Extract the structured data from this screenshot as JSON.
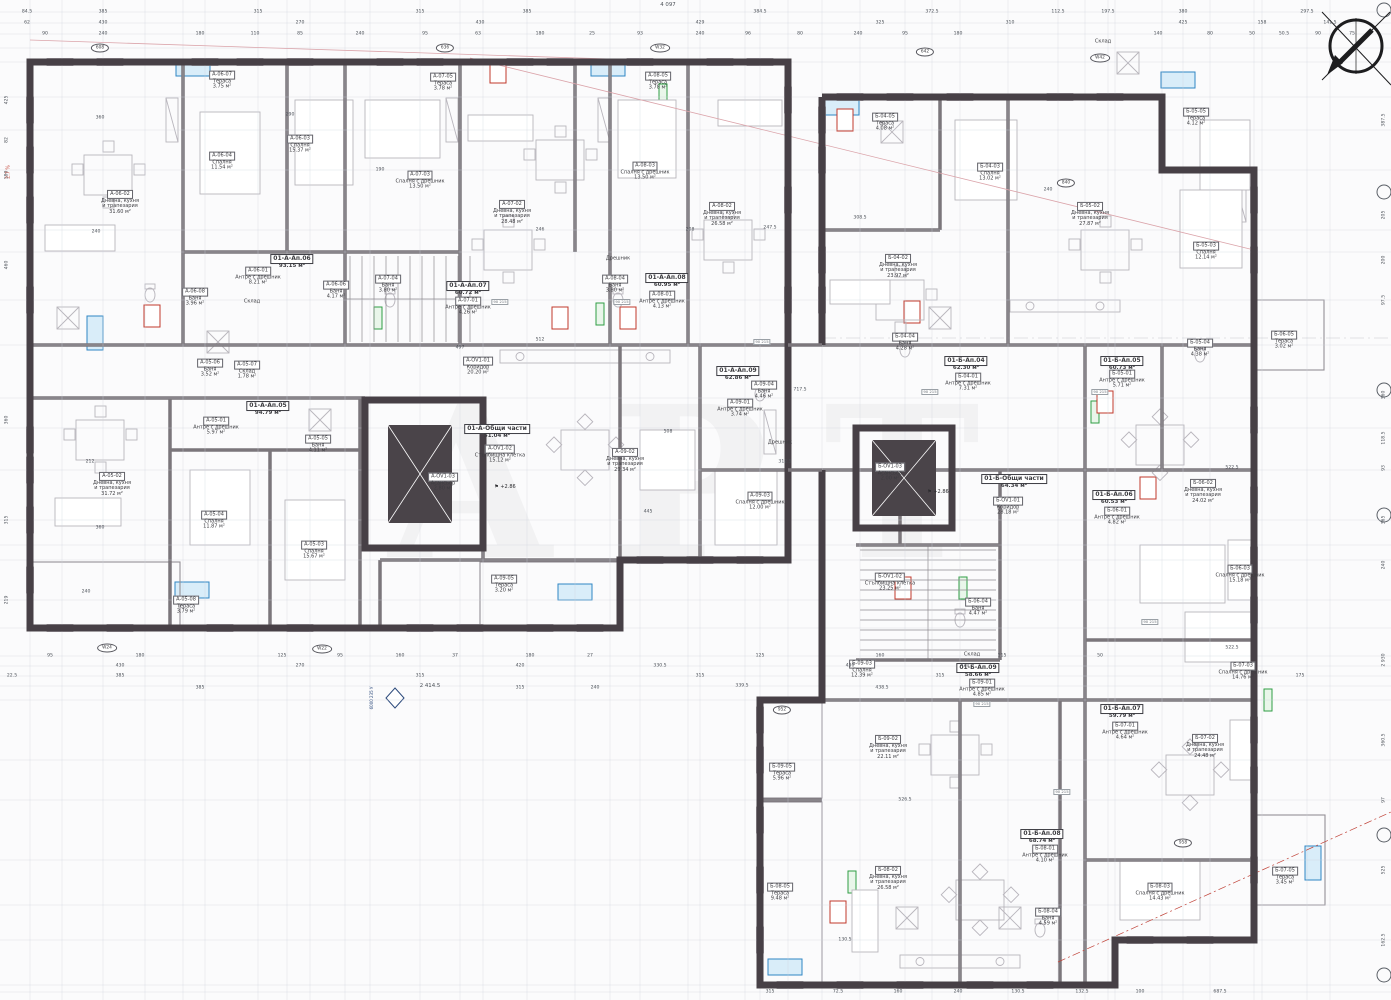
{
  "drawing": {
    "watermark": "АРТ",
    "overall_top": "4 097",
    "overall_bottom": "2 414.5",
    "door_tag": {
      "top": "90",
      "bottom": "215"
    },
    "section_marker": {
      "line1": "6000",
      "line2": "235 У"
    },
    "left_note": "2.7 %"
  },
  "rooms": [
    {
      "code": "А-06-02",
      "name": "Дневна, кухня\nи трапезария",
      "area": "31.60 м²",
      "x": 120,
      "y": 198
    },
    {
      "code": "А-06-04",
      "name": "Спалня",
      "area": "11.54 м²",
      "x": 222,
      "y": 157
    },
    {
      "code": "А-06-03",
      "name": "Спалня",
      "area": "15.37 м²",
      "x": 300,
      "y": 140
    },
    {
      "code": "А-06-07",
      "name": "Тераса",
      "area": "3.75 м²",
      "x": 222,
      "y": 76
    },
    {
      "code": "А-06-01",
      "name": "Антре с дрешник",
      "area": "8.21 м²",
      "x": 258,
      "y": 272
    },
    {
      "code": "А-06-06",
      "name": "Баня",
      "area": "4.17 м²",
      "x": 336,
      "y": 286
    },
    {
      "code": "А-06-08",
      "name": "Баня",
      "area": "3.96 м²",
      "x": 195,
      "y": 293
    },
    {
      "code": "А-07-03",
      "name": "Спалня с дрешник",
      "area": "13.50 м²",
      "x": 420,
      "y": 176
    },
    {
      "code": "А-07-02",
      "name": "Дневна, кухня\nи трапезария",
      "area": "28.48 м²",
      "x": 512,
      "y": 208
    },
    {
      "code": "А-07-05",
      "name": "Тераса",
      "area": "3.78 м²",
      "x": 443,
      "y": 78
    },
    {
      "code": "А-07-01",
      "name": "Антре с дрешник",
      "area": "4.26 м²",
      "x": 468,
      "y": 302
    },
    {
      "code": "А-07-04",
      "name": "Баня",
      "area": "3.80 м²",
      "x": 388,
      "y": 280
    },
    {
      "code": "А-08-03",
      "name": "Спалня с дрешник",
      "area": "13.50 м²",
      "x": 645,
      "y": 167
    },
    {
      "code": "А-08-02",
      "name": "Дневна, кухня\nи трапезария",
      "area": "26.58 м²",
      "x": 722,
      "y": 210
    },
    {
      "code": "А-08-05",
      "name": "Тераса",
      "area": "3.78 м²",
      "x": 658,
      "y": 77
    },
    {
      "code": "А-08-04",
      "name": "Баня",
      "area": "3.80 м²",
      "x": 615,
      "y": 280
    },
    {
      "code": "А-08-01",
      "name": "Антре с дрешник",
      "area": "4.13 м²",
      "x": 662,
      "y": 296
    },
    {
      "code": "А-05-06",
      "name": "Баня",
      "area": "3.52 м²",
      "x": 210,
      "y": 364
    },
    {
      "code": "А-05-07",
      "name": "Склад",
      "area": "1.78 м²",
      "x": 247,
      "y": 366
    },
    {
      "code": "А-05-01",
      "name": "Антре с дрешник",
      "area": "5.97 м²",
      "x": 216,
      "y": 422
    },
    {
      "code": "А-05-05",
      "name": "Баня",
      "area": "4.11 м²",
      "x": 318,
      "y": 440
    },
    {
      "code": "А-05-02",
      "name": "Дневна, кухня\nи трапезария",
      "area": "31.72 м²",
      "x": 112,
      "y": 480
    },
    {
      "code": "А-05-04",
      "name": "Спалня",
      "area": "11.87 м²",
      "x": 214,
      "y": 516
    },
    {
      "code": "А-05-03",
      "name": "Спалня",
      "area": "15.67 м²",
      "x": 314,
      "y": 546
    },
    {
      "code": "А-05-08",
      "name": "Тераса",
      "area": "3.79 м²",
      "x": 186,
      "y": 601
    },
    {
      "code": "А-OV1-01",
      "name": "Коридор",
      "area": "20.20 м²",
      "x": 478,
      "y": 362
    },
    {
      "code": "А-OV1-02",
      "name": "Стълбищна клетка",
      "area": "15.12 м²",
      "x": 500,
      "y": 450
    },
    {
      "code": "А-OV1-03",
      "name": "Асансьор",
      "area": "2.80 м²",
      "x": 443,
      "y": 478
    },
    {
      "code": "А-09-02",
      "name": "Дневна, кухня\nи трапезария",
      "area": "29.34 м²",
      "x": 625,
      "y": 456
    },
    {
      "code": "А-09-05",
      "name": "Тераса",
      "area": "3.20 м²",
      "x": 504,
      "y": 580
    },
    {
      "code": "А-09-03",
      "name": "Спалня с дрешник",
      "area": "12.00 м²",
      "x": 760,
      "y": 497
    },
    {
      "code": "А-09-04",
      "name": "Баня",
      "area": "4.46 м²",
      "x": 764,
      "y": 386
    },
    {
      "code": "А-09-01",
      "name": "Антре с дрешник",
      "area": "3.74 м²",
      "x": 740,
      "y": 404
    },
    {
      "code": "Б-04-05",
      "name": "Тераса",
      "area": "4.08 м²",
      "x": 885,
      "y": 118
    },
    {
      "code": "Б-04-03",
      "name": "Спалня",
      "area": "13.02 м²",
      "x": 990,
      "y": 168
    },
    {
      "code": "Б-04-02",
      "name": "Дневна, кухня\nи трапезария",
      "area": "23.97 м²",
      "x": 898,
      "y": 262
    },
    {
      "code": "Б-04-01",
      "name": "Антре с дрешник",
      "area": "7.31 м²",
      "x": 968,
      "y": 378
    },
    {
      "code": "Б-04-04",
      "name": "Баня",
      "area": "4.28 м²",
      "x": 905,
      "y": 338
    },
    {
      "code": "Б-05-02",
      "name": "Дневна, кухня\nи трапезария",
      "area": "27.87 м²",
      "x": 1090,
      "y": 210
    },
    {
      "code": "Б-05-05",
      "name": "Тераса",
      "area": "4.12 м²",
      "x": 1196,
      "y": 113
    },
    {
      "code": "Б-05-03",
      "name": "Спалня",
      "area": "12.14 м²",
      "x": 1206,
      "y": 247
    },
    {
      "code": "Б-05-04",
      "name": "Баня",
      "area": "4.38 м²",
      "x": 1200,
      "y": 344
    },
    {
      "code": "Б-05-01",
      "name": "Антре с дрешник",
      "area": "5.71 м²",
      "x": 1122,
      "y": 375
    },
    {
      "code": "Б-06-05",
      "name": "Тераса",
      "area": "3.02 м²",
      "x": 1284,
      "y": 336
    },
    {
      "code": "Б-06-02",
      "name": "Дневна, кухня\nи трапезария",
      "area": "24.02 м²",
      "x": 1203,
      "y": 487
    },
    {
      "code": "Б-06-03",
      "name": "Спалня с дрешник",
      "area": "15.18 м²",
      "x": 1240,
      "y": 570
    },
    {
      "code": "Б-06-01",
      "name": "Антре с дрешник",
      "area": "4.82 м²",
      "x": 1117,
      "y": 512
    },
    {
      "code": "Б-06-04",
      "name": "Баня",
      "area": "4.47 м²",
      "x": 978,
      "y": 603
    },
    {
      "code": "Б-OV1-01",
      "name": "Коридор",
      "area": "28.18 м²",
      "x": 1008,
      "y": 502
    },
    {
      "code": "Б-OV1-02",
      "name": "Стълбищна клетка",
      "area": "23.25 м²",
      "x": 890,
      "y": 578
    },
    {
      "code": "Б-OV1-03",
      "name": "Асансьор",
      "area": "2.00 м²",
      "x": 890,
      "y": 468
    },
    {
      "code": "Б-09-03",
      "name": "Спалня",
      "area": "12.39 м²",
      "x": 862,
      "y": 665
    },
    {
      "code": "Б-09-01",
      "name": "Антре с дрешник",
      "area": "4.85 м²",
      "x": 982,
      "y": 684
    },
    {
      "code": "Б-09-02",
      "name": "Дневна, кухня\nи трапезария",
      "area": "22.11 м²",
      "x": 888,
      "y": 743
    },
    {
      "code": "Б-09-05",
      "name": "Тераса",
      "area": "5.96 м²",
      "x": 782,
      "y": 768
    },
    {
      "code": "Б-08-05",
      "name": "Тераса",
      "area": "9.48 м²",
      "x": 780,
      "y": 888
    },
    {
      "code": "Б-08-02",
      "name": "Дневна, кухня\nи трапезария",
      "area": "26.58 м²",
      "x": 888,
      "y": 874
    },
    {
      "code": "Б-08-01",
      "name": "Антре с дрешник",
      "area": "4.10 м²",
      "x": 1045,
      "y": 850
    },
    {
      "code": "Б-08-04",
      "name": "Баня",
      "area": "4.59 м²",
      "x": 1048,
      "y": 913
    },
    {
      "code": "Б-08-03",
      "name": "Спалня с дрешник",
      "area": "14.43 м²",
      "x": 1160,
      "y": 888
    },
    {
      "code": "Б-07-03",
      "name": "Спалня с дрешник",
      "area": "14.76 м²",
      "x": 1243,
      "y": 667
    },
    {
      "code": "Б-07-01",
      "name": "Антре с дрешник",
      "area": "4.64 м²",
      "x": 1125,
      "y": 727
    },
    {
      "code": "Б-07-02",
      "name": "Дневна, кухня\nи трапезария",
      "area": "24.48 м²",
      "x": 1205,
      "y": 742
    },
    {
      "code": "Б-07-05",
      "name": "Тераса",
      "area": "3.45 м²",
      "x": 1285,
      "y": 872
    }
  ],
  "units": [
    {
      "code": "01-А-Ап.06",
      "area": "93.15 м²",
      "x": 292,
      "y": 258
    },
    {
      "code": "01-А-Ап.07",
      "area": "60.72 м²",
      "x": 468,
      "y": 285
    },
    {
      "code": "01-А-Ап.08",
      "area": "60.95 м²",
      "x": 667,
      "y": 277
    },
    {
      "code": "01-А-Ап.05",
      "area": "94.79 м²",
      "x": 268,
      "y": 405
    },
    {
      "code": "01-А-Ап.09",
      "area": "62.86 м²",
      "x": 738,
      "y": 370
    },
    {
      "code": "01-А-Общи части",
      "area": "51.04 м²",
      "x": 497,
      "y": 428
    },
    {
      "code": "01-Б-Ап.04",
      "area": "62.30 м²",
      "x": 966,
      "y": 360
    },
    {
      "code": "01-Б-Ап.05",
      "area": "60.73 м²",
      "x": 1122,
      "y": 360
    },
    {
      "code": "01-Б-Ап.06",
      "area": "60.53 м²",
      "x": 1114,
      "y": 494
    },
    {
      "code": "01-Б-Общи части",
      "area": "64.34 м²",
      "x": 1014,
      "y": 478
    },
    {
      "code": "01-Б-Ап.09",
      "area": "58.66 м²",
      "x": 978,
      "y": 667
    },
    {
      "code": "01-Б-Ап.08",
      "area": "68.74 м²",
      "x": 1042,
      "y": 833
    },
    {
      "code": "01-Б-Ап.07",
      "area": "59.79 м²",
      "x": 1122,
      "y": 708
    }
  ],
  "plain_labels": [
    {
      "text": "Склад",
      "x": 252,
      "y": 302
    },
    {
      "text": "Склад",
      "x": 972,
      "y": 655
    },
    {
      "text": "Склад",
      "x": 1103,
      "y": 42
    },
    {
      "text": "Дрешник",
      "x": 618,
      "y": 259
    },
    {
      "text": "Дрешник",
      "x": 780,
      "y": 443
    }
  ],
  "badges": [
    {
      "t": "608",
      "x": 100,
      "y": 48
    },
    {
      "t": "636",
      "x": 445,
      "y": 48
    },
    {
      "t": "W32",
      "x": 660,
      "y": 48
    },
    {
      "t": "642",
      "x": 925,
      "y": 52
    },
    {
      "t": "W42",
      "x": 1100,
      "y": 58
    },
    {
      "t": "840",
      "x": 1066,
      "y": 183
    },
    {
      "t": "W24",
      "x": 107,
      "y": 648
    },
    {
      "t": "W22",
      "x": 322,
      "y": 649
    },
    {
      "t": "952",
      "x": 782,
      "y": 710
    },
    {
      "t": "958",
      "x": 1183,
      "y": 843
    }
  ],
  "door_tags": [
    {
      "x": 500,
      "y": 302
    },
    {
      "x": 622,
      "y": 302
    },
    {
      "x": 762,
      "y": 342
    },
    {
      "x": 930,
      "y": 392
    },
    {
      "x": 1100,
      "y": 392
    },
    {
      "x": 1150,
      "y": 622
    },
    {
      "x": 982,
      "y": 704
    },
    {
      "x": 1062,
      "y": 792
    }
  ],
  "elevation_marks": [
    {
      "t": "+2.86",
      "x": 505,
      "y": 487
    },
    {
      "t": "+2.86",
      "x": 938,
      "y": 492
    }
  ],
  "dims": {
    "top1": [
      [
        "84.5",
        27
      ],
      [
        "385",
        103
      ],
      [
        "315",
        258
      ],
      [
        "315",
        420
      ],
      [
        "385",
        527
      ],
      [
        "384.5",
        760
      ],
      [
        "372.5",
        932
      ],
      [
        "112.5",
        1058
      ],
      [
        "197.5",
        1108
      ],
      [
        "380",
        1183
      ],
      [
        "297.5",
        1307
      ]
    ],
    "top2": [
      [
        "62",
        27
      ],
      [
        "430",
        103
      ],
      [
        "270",
        300
      ],
      [
        "430",
        480
      ],
      [
        "429",
        700
      ],
      [
        "325",
        880
      ],
      [
        "310",
        1010
      ],
      [
        "425",
        1183
      ],
      [
        "158",
        1262
      ],
      [
        "141.5",
        1330
      ]
    ],
    "top3": [
      [
        "90",
        45
      ],
      [
        "240",
        103
      ],
      [
        "180",
        200
      ],
      [
        "110",
        255
      ],
      [
        "85",
        300
      ],
      [
        "240",
        360
      ],
      [
        "95",
        425
      ],
      [
        "63",
        478
      ],
      [
        "180",
        540
      ],
      [
        "25",
        592
      ],
      [
        "93",
        640
      ],
      [
        "240",
        700
      ],
      [
        "96",
        748
      ],
      [
        "80",
        800
      ],
      [
        "240",
        858
      ],
      [
        "95",
        905
      ],
      [
        "180",
        958
      ],
      [
        "140",
        1158
      ],
      [
        "80",
        1210
      ],
      [
        "50",
        1252
      ],
      [
        "50.5",
        1284
      ],
      [
        "90",
        1318
      ],
      [
        "75",
        1352
      ]
    ],
    "left": [
      [
        "425",
        100
      ],
      [
        "82",
        140
      ],
      [
        "180",
        175
      ],
      [
        "460",
        265
      ],
      [
        "360",
        420
      ],
      [
        "315",
        520
      ],
      [
        "219",
        600
      ]
    ],
    "right": [
      [
        "387.5",
        120
      ],
      [
        "205",
        215
      ],
      [
        "200",
        260
      ],
      [
        "97.5",
        300
      ],
      [
        "360",
        395
      ],
      [
        "118.5",
        438
      ],
      [
        "93",
        468
      ],
      [
        "365",
        520
      ],
      [
        "240",
        565
      ],
      [
        "2 930",
        660
      ],
      [
        "360.5",
        740
      ],
      [
        "97",
        800
      ],
      [
        "525",
        870
      ],
      [
        "162.5",
        940
      ]
    ],
    "bottom1": [
      [
        "95",
        50
      ],
      [
        "180",
        140
      ],
      [
        "125",
        282
      ],
      [
        "95",
        340
      ],
      [
        "160",
        400
      ],
      [
        "37",
        455
      ],
      [
        "180",
        530
      ],
      [
        "27",
        590
      ],
      [
        "125",
        760
      ],
      [
        "160",
        880
      ],
      [
        "115",
        1002
      ],
      [
        "50",
        1100
      ]
    ],
    "bottom2": [
      [
        "430",
        120
      ],
      [
        "270",
        300
      ],
      [
        "420",
        520
      ],
      [
        "330.5",
        660
      ],
      [
        "430",
        850
      ],
      [
        "420",
        965
      ]
    ],
    "bottom3": [
      [
        "22.5",
        12
      ],
      [
        "385",
        120
      ],
      [
        "315",
        420
      ],
      [
        "315",
        700
      ],
      [
        "315",
        940
      ],
      [
        "175",
        1300
      ]
    ],
    "bottom4": [
      [
        "339.5",
        742
      ]
    ],
    "bottomB": [
      [
        "315",
        770
      ],
      [
        "72.5",
        838
      ],
      [
        "160",
        898
      ],
      [
        "240",
        958
      ],
      [
        "130.5",
        1018
      ],
      [
        "132.5",
        1082
      ],
      [
        "100",
        1140
      ],
      [
        "687.5",
        1220
      ]
    ],
    "inner": [
      [
        "360",
        100,
        118
      ],
      [
        "240",
        96,
        232
      ],
      [
        "212",
        90,
        462
      ],
      [
        "360",
        100,
        528
      ],
      [
        "240",
        86,
        592
      ],
      [
        "290",
        290,
        115
      ],
      [
        "190",
        380,
        170
      ],
      [
        "246",
        540,
        230
      ],
      [
        "208",
        690,
        230
      ],
      [
        "247.5",
        770,
        228
      ],
      [
        "497",
        460,
        348
      ],
      [
        "512",
        540,
        340
      ],
      [
        "445",
        648,
        512
      ],
      [
        "508",
        668,
        432
      ],
      [
        "312.5",
        785,
        462
      ],
      [
        "717.5",
        800,
        390
      ],
      [
        "308.5",
        860,
        218
      ],
      [
        "240",
        1048,
        190
      ],
      [
        "522.5",
        1232,
        468
      ],
      [
        "522.5",
        1232,
        648
      ],
      [
        "438.5",
        882,
        688
      ],
      [
        "526.5",
        905,
        800
      ],
      [
        "130.5",
        845,
        940
      ],
      [
        "240",
        595,
        688
      ],
      [
        "315",
        520,
        688
      ],
      [
        "385",
        200,
        688
      ]
    ]
  }
}
